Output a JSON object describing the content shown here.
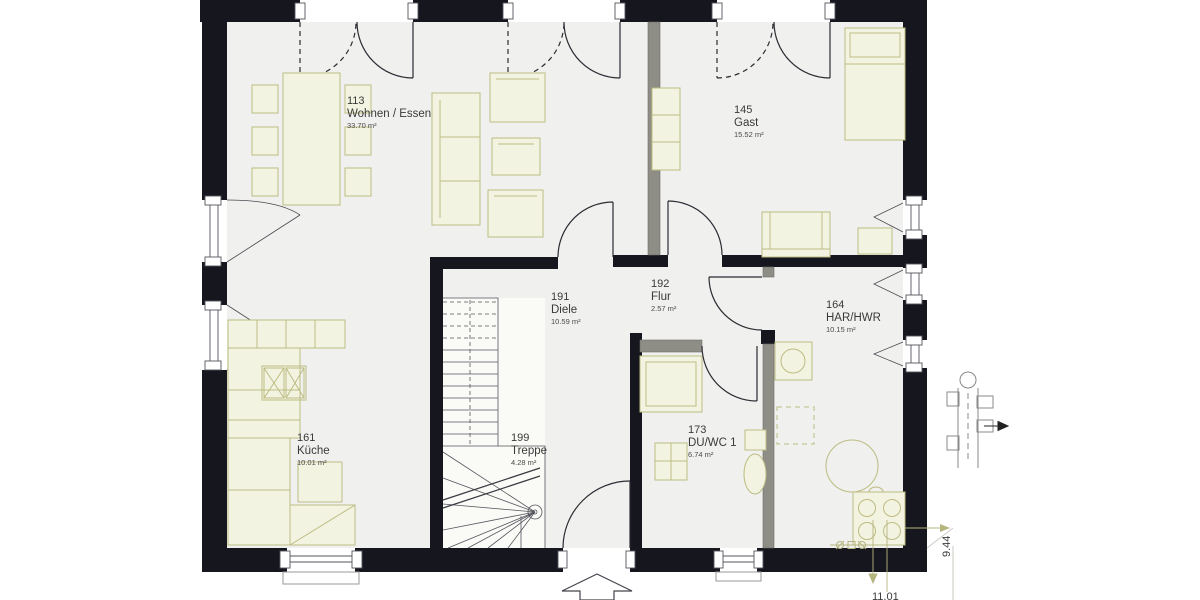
{
  "plan": {
    "rooms": [
      {
        "number": "113",
        "name": "Wohnen / Essen",
        "area": "33.70 m²"
      },
      {
        "number": "145",
        "name": "Gast",
        "area": "15.52 m²"
      },
      {
        "number": "191",
        "name": "Diele",
        "area": "10.59 m²"
      },
      {
        "number": "192",
        "name": "Flur",
        "area": "2.57 m²"
      },
      {
        "number": "164",
        "name": "HAR/HWR",
        "area": "10.15 m²"
      },
      {
        "number": "161",
        "name": "Küche",
        "area": "10.01 m²"
      },
      {
        "number": "199",
        "name": "Treppe",
        "area": "4.28 m²"
      },
      {
        "number": "173",
        "name": "DU/WC 1",
        "area": "6.74 m²"
      }
    ],
    "dimensions": {
      "right": "9.44",
      "bottom": "11.01"
    },
    "colors": {
      "wall": "#16161e",
      "partition": "#8e8e86",
      "floor": "#f0f0ee",
      "furniture_stroke": "#bcbc82",
      "furniture_fill": "#f3f3e1",
      "dimension": "#b5b580",
      "text": "#3a3a3a"
    }
  }
}
